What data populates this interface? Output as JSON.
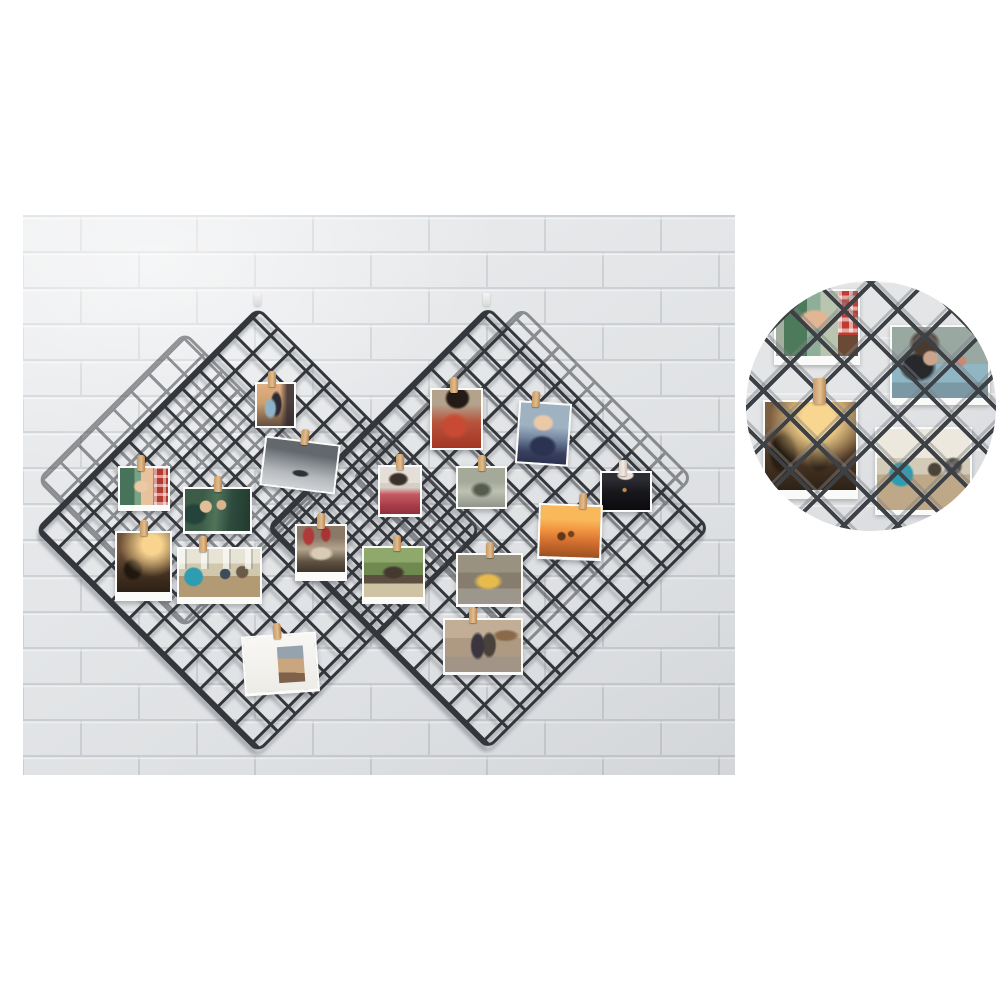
{
  "scene": {
    "description": "Product photo: four black wire mesh grid panels hung in diamond orientation on a white painted brick wall, displaying small photos attached with wooden clothespins; circular zoom detail of the grid with photos at top right; white page background",
    "background_color": "#ffffff",
    "mesh_color": "#33363a",
    "wall": {
      "x": 23,
      "y": 215,
      "w": 712,
      "h": 560,
      "brick_color": "#e8eaec",
      "mortar_shadow": "#cdd1d5",
      "mortar_highlight": "#f7f8f9"
    }
  },
  "panels": [
    {
      "id": "back-left",
      "layer": "back",
      "cx": 185,
      "cy": 480,
      "size": 210
    },
    {
      "id": "back-right",
      "layer": "back",
      "cx": 522,
      "cy": 478,
      "size": 242
    },
    {
      "id": "front-left",
      "layer": "front",
      "cx": 258,
      "cy": 530,
      "size": 316
    },
    {
      "id": "front-right",
      "layer": "front",
      "cx": 488,
      "cy": 528,
      "size": 314
    }
  ],
  "hooks": [
    {
      "x": 254,
      "y": 293
    },
    {
      "x": 483,
      "y": 293
    }
  ],
  "photos": [
    {
      "id": "sunset-couple",
      "desc": "couple embracing at dusk, warm sky, dark building right",
      "x": 255,
      "y": 382,
      "w": 41,
      "h": 44,
      "rot": 0,
      "strip": 2,
      "clips": [
        {
          "f": 0.42
        }
      ],
      "bg": "radial-gradient(ellipse 30% 45% at 36% 58%, #8fb3c6 0 40%, rgba(143,179,198,0) 60%), radial-gradient(ellipse 24% 48% at 52% 48%, #2e2a32 0 50%, rgba(46,42,50,0) 68%), linear-gradient(90deg, rgba(42,38,46,0) 62%, rgba(42,38,46,0.8) 82%), linear-gradient(180deg,#e2b083 0%,#cfa06e 45%,#8a6a50 80%,#63503f 100%)"
    },
    {
      "id": "woman-in-red",
      "desc": "woman with long black hair wearing red embroidered garment, tan background",
      "x": 430,
      "y": 388,
      "w": 53,
      "h": 60,
      "rot": 0,
      "strip": 2,
      "clips": [
        {
          "f": 0.45
        }
      ],
      "bg": "radial-gradient(ellipse 34% 26% at 52% 14%, #241b16 0 60%, rgba(36,27,22,0) 78%), radial-gradient(ellipse 42% 34% at 46% 62%, #c94a32 0 45%, rgba(201,74,50,0) 70%), linear-gradient(180deg,#b3a28c 0 25%,#b8543c 55%,#a33524 100%)"
    },
    {
      "id": "man-glasses",
      "desc": "young man with glasses, dark sweater over white shirt, light blue background",
      "x": 517,
      "y": 402,
      "w": 53,
      "h": 61,
      "rot": 4,
      "strip": 2,
      "clips": [
        {
          "f": 0.35
        }
      ],
      "bg": "radial-gradient(ellipse 30% 20% at 48% 32%, #ecc9a6 0 55%, rgba(236,201,166,0) 75%), radial-gradient(ellipse 40% 26% at 50% 72%, #2b3352 0 55%, rgba(43,51,82,0) 75%), linear-gradient(180deg,#9fb2c2 0 38%,#7486a0 58%,#39415e 82%,#2b3350 100%)"
    },
    {
      "id": "grey-seascape",
      "desc": "black and white sea shore with small boat, tilted",
      "x": 262,
      "y": 440,
      "w": 76,
      "h": 48,
      "rot": 7,
      "strip": 2,
      "clips": [
        {
          "f": 0.57
        }
      ],
      "bg": "radial-gradient(ellipse 16% 10% at 52% 68%, #2e3237 0 55%, rgba(46,50,55,0) 80%), linear-gradient(183deg,#63686d 0 25%,#898e93 45%,#b6babe 70%,#d3d6d9 100%)"
    },
    {
      "id": "holding-hands-plaid",
      "desc": "couple holding hands, green blur left, red plaid shirt right",
      "x": 118,
      "y": 466,
      "w": 52,
      "h": 39,
      "rot": 0,
      "strip": 6,
      "clips": [
        {
          "f": 0.45
        }
      ],
      "bg": "repeating-linear-gradient(90deg, rgba(255,255,255,.5) 0 3px, rgba(255,255,255,0) 3px 9px) 100% 0/30% 100% no-repeat, repeating-linear-gradient(0deg, rgba(255,255,255,.5) 0 3px, rgba(255,255,255,0) 3px 9px) 100% 0/30% 100% no-repeat, radial-gradient(ellipse 24% 26% at 44% 50%, #ecc8a4 0 50%, rgba(236,200,164,0) 70%), linear-gradient(90deg,#47735a 0 30%,#7aa386 30% 44%,#e7c29c 44% 70%,#b23a2e 70% 100%)"
    },
    {
      "id": "couple-lying",
      "desc": "couple lying on dark green blanket outdoors",
      "x": 183,
      "y": 487,
      "w": 69,
      "h": 44,
      "rot": 0,
      "strip": 3,
      "clips": [
        {
          "f": 0.5
        }
      ],
      "bg": "radial-gradient(circle at 32% 42%, #e2bf99 0 11%, rgba(226,191,153,0) 13%), radial-gradient(circle at 56% 38%, #dab48e 0 10%, rgba(218,180,142,0) 12%), radial-gradient(ellipse 30% 40% at 14% 60%, #24433a 0 50%, rgba(36,67,58,0) 70%), linear-gradient(95deg,#3c5c48 0 28%,#507459 48%,#2e4b3e 70%,#223a2e 100%)"
    },
    {
      "id": "pink-sweater-woman",
      "desc": "dark-haired woman in pink-red sweater on white background",
      "x": 378,
      "y": 465,
      "w": 44,
      "h": 49,
      "rot": 0,
      "strip": 3,
      "clips": [
        {
          "f": 0.5
        }
      ],
      "bg": "radial-gradient(ellipse 38% 22% at 46% 26%, #3c302a 0 50%, rgba(60,48,42,0) 70%), linear-gradient(180deg,#e4dfd7 0 34%,#d6cfc6 34% 44%,#c65a64 58%,#a83c48 82%,#8e3040 100%)"
    },
    {
      "id": "foggy-forest",
      "desc": "misty grey-olive landscape",
      "x": 456,
      "y": 466,
      "w": 51,
      "h": 41,
      "rot": 0,
      "strip": 2,
      "clips": [
        {
          "f": 0.5
        }
      ],
      "bg": "radial-gradient(ellipse 34% 30% at 50% 56%, #555b4d 0 40%, rgba(85,91,77,0) 72%), linear-gradient(180deg,#a4a99a 0 35%,#bdc1b2 60%,#90958b 100%)"
    },
    {
      "id": "dark-night-photo",
      "desc": "nearly black photo with small warm light, pale notch at top",
      "x": 600,
      "y": 471,
      "w": 52,
      "h": 39,
      "rot": 0,
      "strip": 2,
      "clips": [
        {
          "f": 0.45,
          "bg": "linear-gradient(90deg,#ddd2c8,#f2e9e1 55%,#cdbfb2)"
        }
      ],
      "bg": "radial-gradient(ellipse 24% 18% at 49% 6%, #eadfd6 0 60%, rgba(234,223,214,0) 78%), radial-gradient(circle at 47% 46%, #c9874a 0 5%, rgba(201,135,74,0) 8%), linear-gradient(180deg,#2c2c33 0 16%,#17171c 52%,#0b0b0f 100%)"
    },
    {
      "id": "party-warm-light",
      "desc": "silhouetted people at party with warm sun flare, polaroid frame",
      "x": 115,
      "y": 531,
      "w": 57,
      "h": 61,
      "rot": 0,
      "strip": 9,
      "clips": [
        {
          "f": 0.5
        }
      ],
      "bg": "radial-gradient(circle at 66% 20%, #f9d48e 0 16%, rgba(249,212,142,0) 55%), radial-gradient(ellipse 30% 30% at 30% 62%, #1f1710 0 45%, rgba(31,23,16,0) 68%), linear-gradient(180deg,#6e5138 0 30%,#4b3524 60%,#2c2015 100%)"
    },
    {
      "id": "group-on-floor",
      "desc": "friends sitting on wood floor by bright windows, man in teal shirt",
      "x": 177,
      "y": 547,
      "w": 85,
      "h": 50,
      "rot": 0,
      "strip": 7,
      "clips": [
        {
          "f": 0.3
        }
      ],
      "bg": "repeating-linear-gradient(90deg, rgba(255,255,255,.6) 0 6px, rgba(72,76,72,.22) 6px 8px, rgba(255,255,255,0) 8px 22px) 50% 0/100% 42% no-repeat, radial-gradient(circle at 18% 58%, #2f9db1 0 12%, rgba(47,157,177,0) 14%), radial-gradient(circle at 57% 52%, #3e4c5a 0 9%, rgba(62,76,90,0) 11%), radial-gradient(circle at 78% 48%, #6a5a48 0 8%, rgba(106,90,72,0) 10%), linear-gradient(180deg,#e7e3d5 0 30%,#d0c7ad 30% 56%,#b29a74 56% 100%)"
    },
    {
      "id": "red-ceremony",
      "desc": "gathering with red drapes at top, cream center, dark figures below",
      "x": 295,
      "y": 524,
      "w": 52,
      "h": 48,
      "rot": 0,
      "strip": 9,
      "clips": [
        {
          "f": 0.5
        }
      ],
      "bg": "radial-gradient(ellipse 18% 30% at 24% 22%, #b03a3a 0 55%, rgba(176,58,58,0) 75%), radial-gradient(ellipse 16% 26% at 60% 18%, #a83434 0 50%, rgba(168,52,52,0) 72%), radial-gradient(ellipse 40% 24% at 50% 60%, #d9ccb6 0 45%, rgba(217,204,182,0) 68%), linear-gradient(180deg,#8a7868 0 25%,#b4a48e 50%,#5e5142 78%,#3e352a 100%)"
    },
    {
      "id": "park-bench-couple",
      "desc": "couple sitting on bench in green park, light path below",
      "x": 362,
      "y": 546,
      "w": 63,
      "h": 51,
      "rot": 0,
      "strip": 7,
      "clips": [
        {
          "f": 0.55
        }
      ],
      "bg": "radial-gradient(ellipse 28% 20% at 50% 50%, #443931 0 50%, rgba(68,57,49,0) 72%), linear-gradient(180deg,#8fa96c 0 30%,#6f8950 30% 55%,#5d4f3f 55% 72%,#cec3a3 72% 100%)"
    },
    {
      "id": "yellow-tram",
      "desc": "yellow tram on grey street",
      "x": 456,
      "y": 553,
      "w": 67,
      "h": 51,
      "rot": 0,
      "strip": 3,
      "clips": [
        {
          "f": 0.5
        }
      ],
      "bg": "radial-gradient(ellipse 36% 28% at 48% 54%, #e6bb4c 0 42%, rgba(230,187,76,0) 66%), linear-gradient(180deg,#9a9281 0 36%,#867d6e 36% 68%,#9c968c 68% 100%)"
    },
    {
      "id": "sunset-beach",
      "desc": "people playing on beach against bright orange sunset",
      "x": 538,
      "y": 504,
      "w": 64,
      "h": 53,
      "rot": 2,
      "strip": 3,
      "clips": [
        {
          "f": 0.7
        }
      ],
      "bg": "radial-gradient(circle at 36% 60%, #63361a 0 7%, rgba(99,54,26,0) 10%), radial-gradient(circle at 52% 55%, #74401e 0 6%, rgba(116,64,30,0) 9%), linear-gradient(180deg,#f9b95a 0 26%,#f19240 48%,#d26f2f 70%,#9c5122 100%)"
    },
    {
      "id": "street-couple-walking",
      "desc": "couple walking away down warm-toned street, shoulder bags",
      "x": 443,
      "y": 618,
      "w": 80,
      "h": 54,
      "rot": 0,
      "strip": 3,
      "clips": [
        {
          "f": 0.38
        }
      ],
      "bg": "radial-gradient(ellipse 13% 36% at 43% 50%, #3b3540 0 58%, rgba(59,53,64,0) 78%), radial-gradient(ellipse 13% 34% at 58% 48%, #49423b 0 58%, rgba(73,66,59,0) 78%), radial-gradient(ellipse 30% 20% at 80% 30%, #8a6a4a 0 40%, rgba(138,106,74,0) 62%), linear-gradient(180deg,#c2ae96 0 35%,#ae9a82 35% 70%,#a29588 70% 100%)"
    },
    {
      "id": "white-postcard",
      "desc": "white card tilted, small photo of embracing couple at lower right",
      "x": 243,
      "y": 634,
      "w": 75,
      "h": 57,
      "rot": -4,
      "strip": 3,
      "clips": [
        {
          "f": 0.45
        }
      ],
      "bg": "linear-gradient(185deg,#94a3ae 0 35%,#c9a67d 35% 72%,#7e624b 72% 100%) no-repeat right 12px bottom 8px / 26px 36px, linear-gradient(180deg,#f8f7f4 0%,#edece7 100%)"
    }
  ],
  "inset": {
    "x": 746,
    "y": 281,
    "d": 250,
    "desc": "circular zoom detail of mesh grid with four clipped photos",
    "mesh_color": "#3d4145",
    "wall_color_a": "#e3e5e7",
    "wall_color_b": "#d8dadd",
    "photos": [
      {
        "id": "hands-plaid-zoom",
        "desc": "close-up of couple holding hands, red plaid shirt at right",
        "x": 28,
        "y": 8,
        "w": 86,
        "h": 67,
        "strip": 9,
        "bg": "repeating-linear-gradient(90deg, rgba(255,255,255,.55) 0 4px, rgba(255,255,255,0) 4px 11px) 100% 0/24% 64% no-repeat, repeating-linear-gradient(0deg, rgba(255,255,255,.55) 0 4px, rgba(255,255,255,0) 4px 11px) 100% 0/24% 64% no-repeat, linear-gradient(0deg,#6a4a34 0 32%, rgba(106,74,52,0) 32%) 100% 0/24% 100% no-repeat, radial-gradient(ellipse 26% 22% at 47% 44%, #e2b694 0 55%, rgba(226,182,148,0) 75%), linear-gradient(90deg,#a3b0a0 0 10%,#4e7a5c 10% 38%,#8fae9a 38% 54%,#bac5af 54% 76%,#c03c30 76% 100%)"
      },
      {
        "id": "woman-desk-zoom",
        "desc": "woman with hair bun in black top leaning on teal work surface",
        "x": 144,
        "y": 44,
        "w": 100,
        "h": 73,
        "strip": 7,
        "bg": "radial-gradient(circle at 40% 44%, #caa58c 0 9%, rgba(202,165,140,0) 12%), radial-gradient(ellipse 24% 30% at 34% 24%, #4a3a30 0 50%, rgba(74,58,48,0) 70%), radial-gradient(ellipse 28% 32% at 27% 56%, #26282b 0 52%, rgba(38,40,43,0) 70%), radial-gradient(circle at 72% 48%, #c98a74 0 5%, rgba(201,138,116,0) 8%), linear-gradient(180deg,#9aa8a2 0 52%,#8fb6c2 52% 78%,#7a99a4 78% 100%)"
      },
      {
        "id": "party-warm-zoom",
        "desc": "close-up of party photo with warm sun flare and dark silhouettes",
        "x": 17,
        "y": 119,
        "w": 95,
        "h": 90,
        "strip": 9,
        "bg": "radial-gradient(circle at 58% 20%, #f9d68f 0 18%, rgba(249,214,143,0) 55%), radial-gradient(ellipse 24% 38% at 20% 58%, #291e14 0 50%, rgba(41,30,20,0) 70%), radial-gradient(ellipse 20% 30% at 60% 62%, #30241a 0 45%, rgba(48,36,26,0) 66%), linear-gradient(180deg,#7c5e40 0 28%,#4e3826 58%,#2e2216 100%)"
      },
      {
        "id": "group-room-zoom",
        "desc": "close-up of group in bright room, man in teal shirt, windows behind",
        "x": 129,
        "y": 146,
        "w": 97,
        "h": 83,
        "strip": 5,
        "bg": "radial-gradient(circle at 26% 56%, #2e9cb0 0 13%, rgba(46,156,176,0) 16%), radial-gradient(circle at 62% 50%, #4a4438 0 8%, rgba(74,68,56,0) 11%), radial-gradient(circle at 82% 46%, #56514b 0 8%, rgba(86,81,75,0) 11%), linear-gradient(180deg,#ece8dd 0 36%,#d3cbb7 36% 56%,#bfa887 56% 100%)"
      }
    ],
    "clip": {
      "x": 67,
      "y": 97,
      "w": 13,
      "h": 26
    }
  }
}
